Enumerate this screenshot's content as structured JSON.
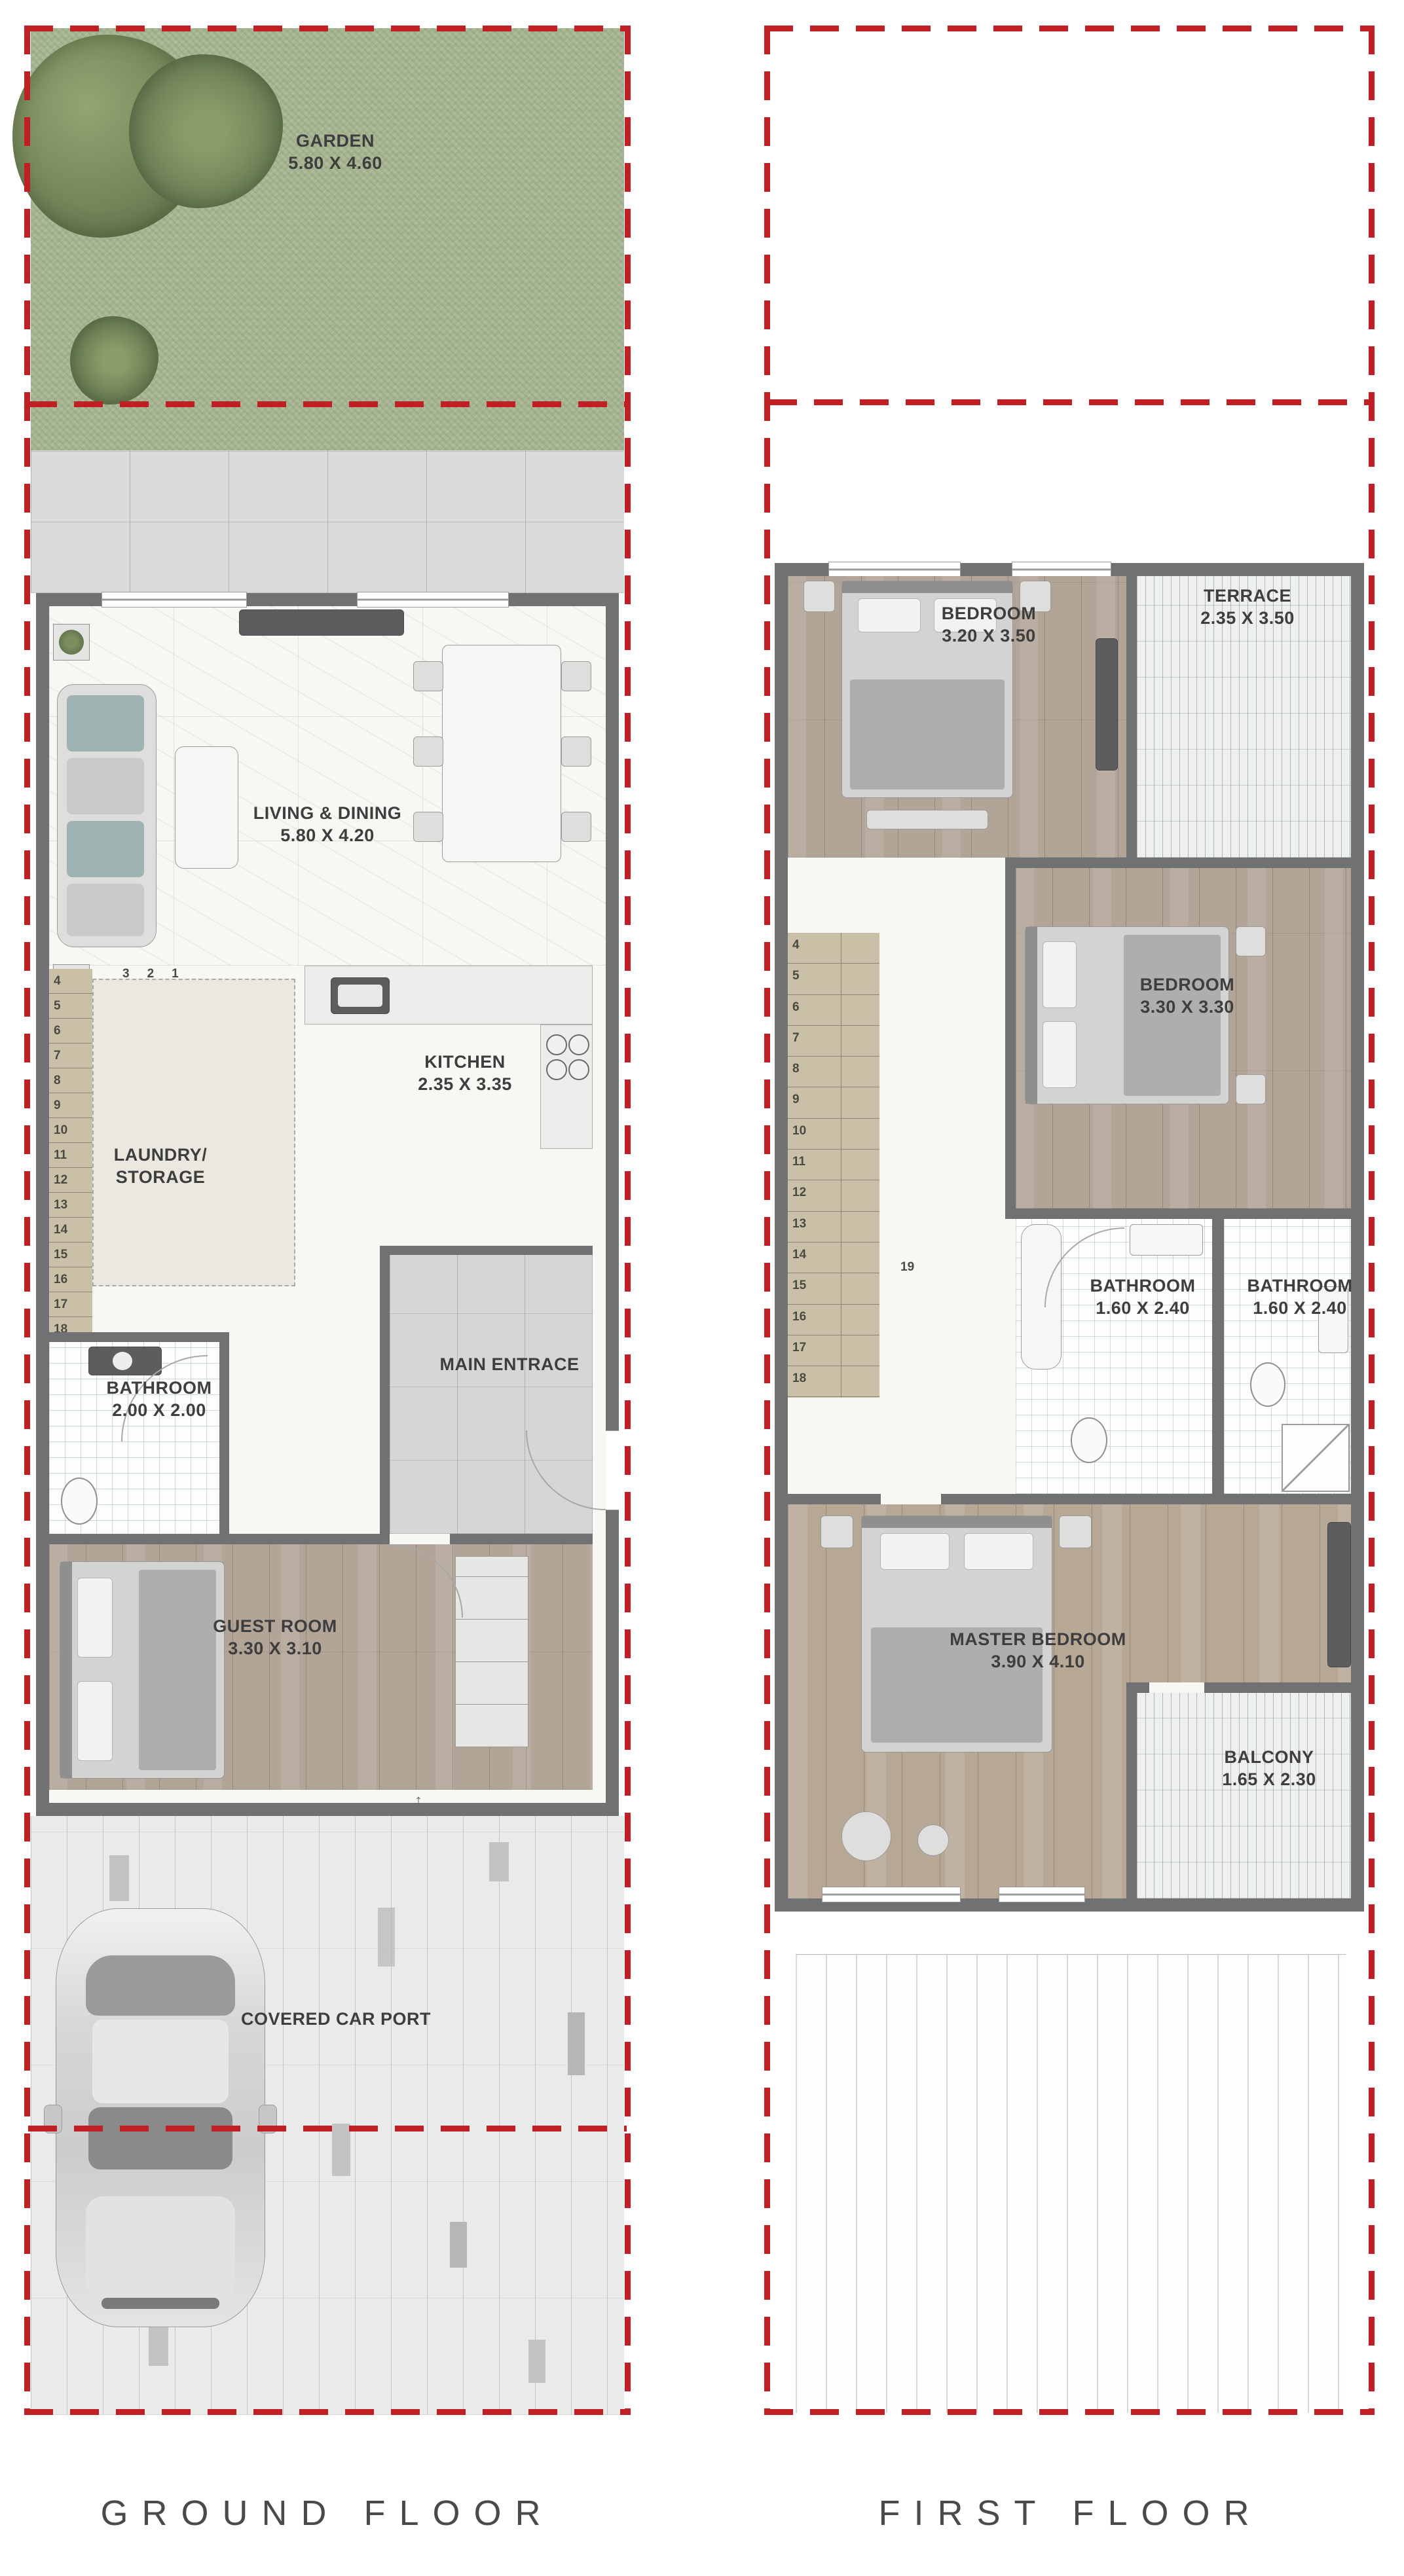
{
  "colors": {
    "accent_red": "#c01f24",
    "wall_gray": "#707173",
    "grass_green": "#a8b693",
    "stair_tan": "#c9c0a7",
    "label_gray": "#3e3e3e"
  },
  "ground_floor": {
    "title": "GROUND FLOOR",
    "garden": {
      "name": "GARDEN",
      "dim": "5.80 X 4.60"
    },
    "living_dining": {
      "name": "LIVING & DINING",
      "dim": "5.80 X 4.20"
    },
    "kitchen": {
      "name": "KITCHEN",
      "dim": "2.35 X 3.35"
    },
    "laundry": {
      "line1": "LAUNDRY/",
      "line2": "STORAGE"
    },
    "bathroom": {
      "name": "BATHROOM",
      "dim": "2.00 X 2.00"
    },
    "main_entrance": {
      "name": "MAIN ENTRACE"
    },
    "guest_room": {
      "name": "GUEST ROOM",
      "dim": "3.30 X 3.10"
    },
    "car_port": {
      "name": "COVERED CAR PORT"
    },
    "stair_top_numbers": [
      "3",
      "2",
      "1"
    ],
    "stair_numbers": [
      "4",
      "5",
      "6",
      "7",
      "8",
      "9",
      "10",
      "11",
      "12",
      "13",
      "14",
      "15",
      "16",
      "17",
      "18"
    ],
    "stair_landing_number": "19",
    "entry_arrow": "↑"
  },
  "first_floor": {
    "title": "FIRST FLOOR",
    "bedroom_1": {
      "name": "BEDROOM",
      "dim": "3.20 X 3.50"
    },
    "terrace": {
      "name": "TERRACE",
      "dim": "2.35 X 3.50"
    },
    "bedroom_2": {
      "name": "BEDROOM",
      "dim": "3.30 X 3.30"
    },
    "bathroom_1": {
      "name": "BATHROOM",
      "dim": "1.60 X 2.40"
    },
    "bathroom_2": {
      "name": "BATHROOM",
      "dim": "1.60 X 2.40"
    },
    "master_bedroom": {
      "name": "MASTER BEDROOM",
      "dim": "3.90 X 4.10"
    },
    "balcony": {
      "name": "BALCONY",
      "dim": "1.65 X 2.30"
    },
    "stair_numbers": [
      "4",
      "5",
      "6",
      "7",
      "8",
      "9",
      "10",
      "11",
      "12",
      "13",
      "14",
      "15",
      "16",
      "17",
      "18"
    ],
    "stair_landing_number": "19"
  }
}
